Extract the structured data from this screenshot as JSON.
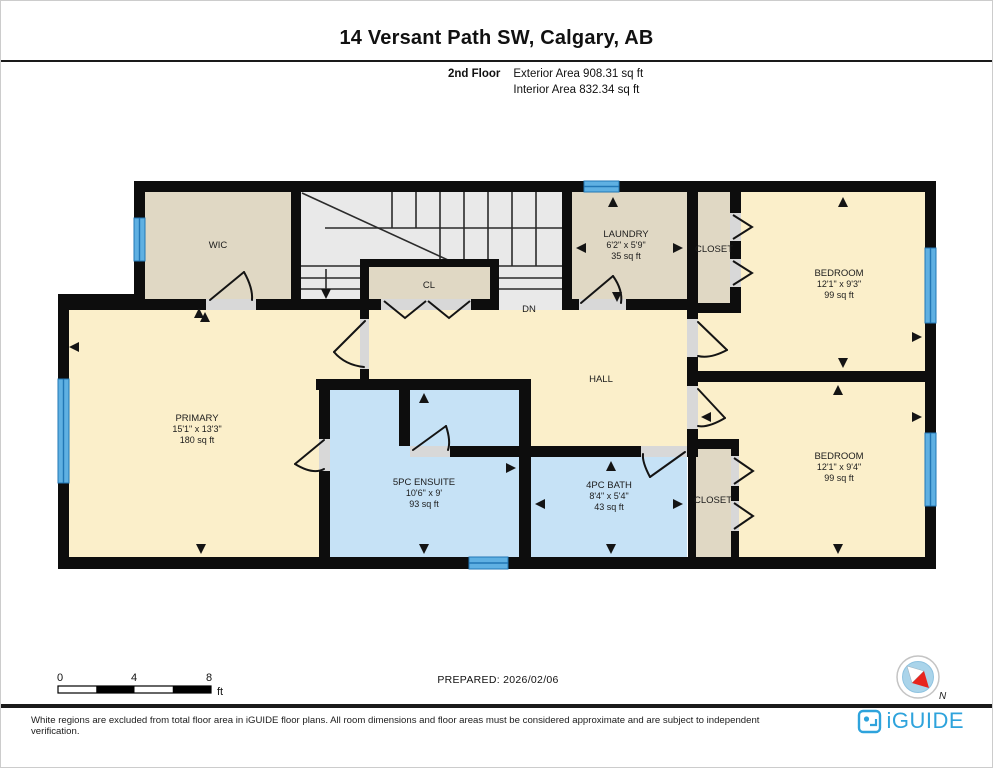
{
  "header": {
    "title": "14 Versant Path SW, Calgary, AB",
    "floor": "2nd Floor",
    "exterior": "Exterior Area 908.31 sq ft",
    "interior": "Interior Area 832.34 sq ft"
  },
  "rooms": {
    "wic": {
      "name": "WIC"
    },
    "cl": {
      "name": "CL"
    },
    "dn": {
      "name": "DN"
    },
    "hall": {
      "name": "HALL"
    },
    "laundry": {
      "name": "LAUNDRY",
      "dims": "6'2\" x 5'9\"",
      "area": "35 sq ft"
    },
    "closet1": {
      "name": "CLOSET"
    },
    "closet2": {
      "name": "CLOSET"
    },
    "bedroom1": {
      "name": "BEDROOM",
      "dims": "12'1\" x 9'3\"",
      "area": "99 sq ft"
    },
    "bedroom2": {
      "name": "BEDROOM",
      "dims": "12'1\" x 9'4\"",
      "area": "99 sq ft"
    },
    "primary": {
      "name": "PRIMARY",
      "dims": "15'1\" x 13'3\"",
      "area": "180 sq ft"
    },
    "ensuite": {
      "name": "5PC ENSUITE",
      "dims": "10'6\" x 9'",
      "area": "93 sq ft"
    },
    "bath": {
      "name": "4PC BATH",
      "dims": "8'4\" x 5'4\"",
      "area": "43 sq ft"
    }
  },
  "scale": {
    "t0": "0",
    "t4": "4",
    "t8": "8",
    "unit": "ft"
  },
  "prepared": "PREPARED: 2026/02/06",
  "compass": {
    "label": "N"
  },
  "footer": {
    "disclaimer": "White regions are excluded from total floor area in iGUIDE floor plans. All room dimensions and floor areas must be considered approximate and are subject to independent verification.",
    "brand": "iGUIDE"
  },
  "colors": {
    "room": "#fbefca",
    "utility": "#e0d8c4",
    "bath": "#c6e2f6",
    "stairs": "#e9e9e9",
    "window": "#5fb0e2",
    "wall": "#0d0d0d",
    "brand": "#2ea3dc"
  }
}
